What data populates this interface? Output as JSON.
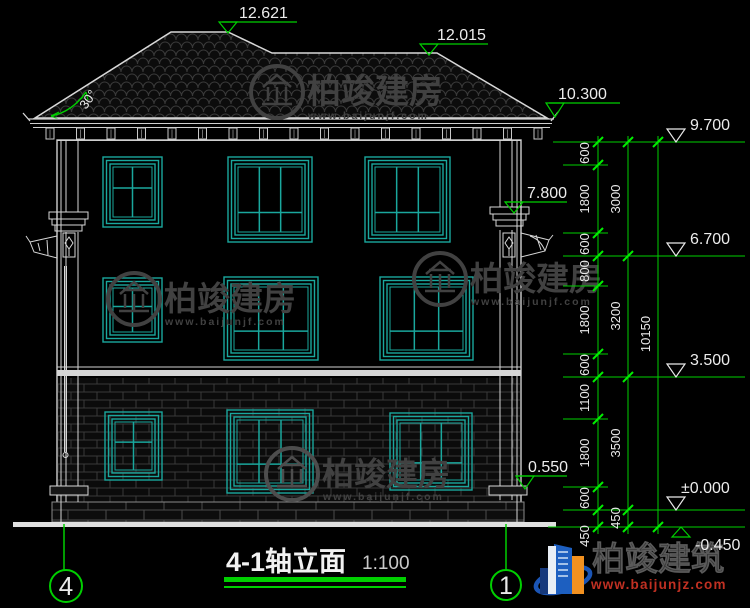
{
  "drawing": {
    "title": "4-1轴立面",
    "scale": "1:100",
    "slope": "30°",
    "axis_left": "4",
    "axis_right": "1"
  },
  "elevations": {
    "ridge_main": "12.621",
    "ridge_side": "12.015",
    "eave": "10.300",
    "top": "9.700",
    "capital": "7.800",
    "floor3": "6.700",
    "floor2": "3.500",
    "porch": "0.550",
    "zero": "±0.000",
    "ground": "-0.450"
  },
  "dims": {
    "chain1": [
      "600",
      "1800",
      "600",
      "800",
      "1800",
      "600",
      "1100",
      "1800",
      "600",
      "450"
    ],
    "chain2": [
      "3000",
      "3200",
      "3500",
      "450"
    ],
    "total": "10150"
  },
  "watermark": {
    "name": "柏竣建房",
    "url": "www.baijunjf.com"
  },
  "brand": {
    "name": "柏竣建筑",
    "url": "www.baijunjz.com"
  },
  "colors": {
    "dimension": "#00cf00",
    "window": "#1aa79d",
    "line": "#d8d8d8",
    "brand_url": "#c03022"
  }
}
